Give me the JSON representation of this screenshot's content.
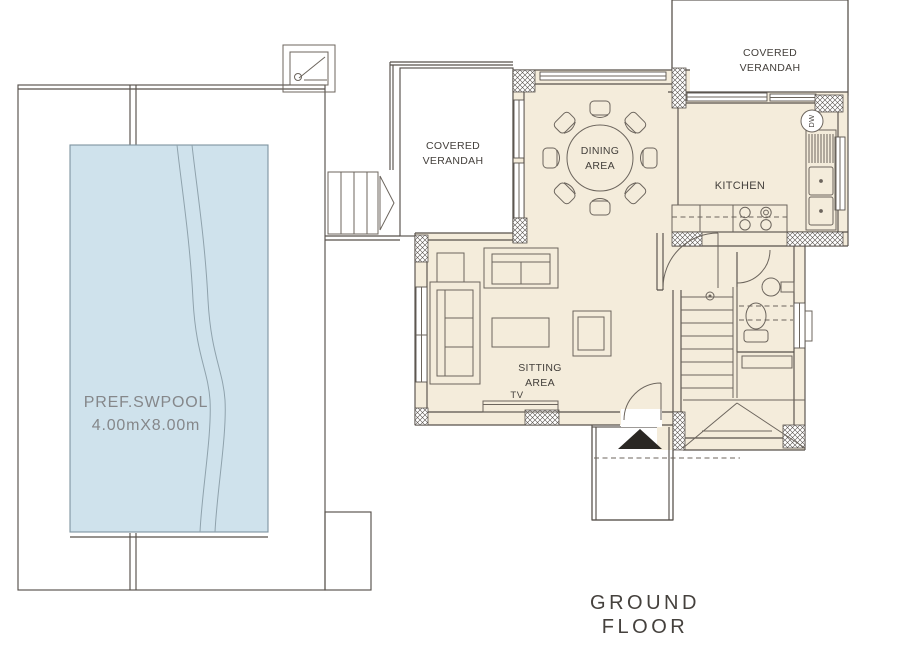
{
  "title": "GROUND FLOOR",
  "pool": {
    "name": "PREF.SWPOOL",
    "dimensions": "4.00mX8.00m"
  },
  "rooms": {
    "dining": {
      "line1": "DINING",
      "line2": "AREA"
    },
    "sitting": {
      "line1": "SITTING",
      "line2": "AREA"
    },
    "kitchen": {
      "label": "KITCHEN"
    },
    "verandah_top": {
      "line1": "COVERED",
      "line2": "VERANDAH"
    },
    "verandah_left": {
      "line1": "COVERED",
      "line2": "VERANDAH"
    }
  },
  "appliances": {
    "dishwasher": "DW",
    "tv": "TV"
  },
  "colors": {
    "floor_cream": "#f4ecdb",
    "pool_blue": "#cfe2ec",
    "pool_edge": "#7e93a0",
    "pool_lane": "#8fa2ac",
    "line_dark": "#57514b",
    "furn_line": "#6c655d",
    "grid_line": "#8d857a",
    "label_text": "#44403c",
    "pool_text": "#85878a",
    "title_text": "#45413d",
    "entrance_black": "#2a2723"
  }
}
